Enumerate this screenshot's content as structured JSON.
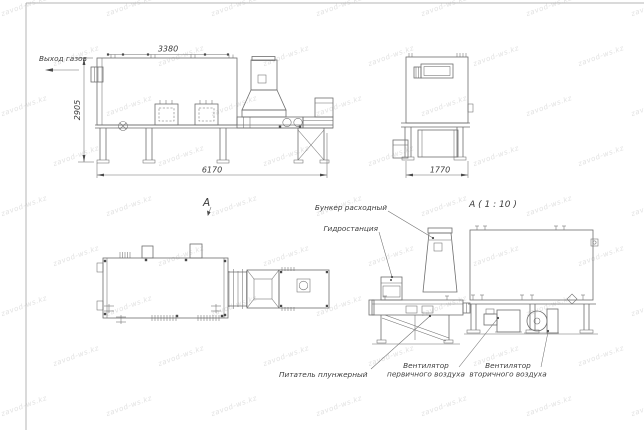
{
  "watermark": {
    "text": "zavod-ws.kz"
  },
  "colors": {
    "background": "#ffffff",
    "line": "#6e6e6e",
    "line_light": "#b4b4b4",
    "text": "#3d3d3d",
    "fill": "#4a4a4a",
    "watermark": "#e2e2e2"
  },
  "front_view": {
    "gas_outlet_label": "Выход газов",
    "dim_top": "3380",
    "dim_height": "2905",
    "dim_length": "6170",
    "view_label": "А"
  },
  "side_view": {
    "dim_width": "1770"
  },
  "detail_view": {
    "title": "А ( 1 : 10 )",
    "callout_hopper": "Бункер расходный",
    "callout_hydraulic": "Гидростанция",
    "callout_feeder": "Питатель плунжерный",
    "callout_primary_fan_1": "Вентилятор",
    "callout_primary_fan_2": "первичного воздуха",
    "callout_secondary_fan_1": "Вентилятор",
    "callout_secondary_fan_2": "вторичного воздуха"
  }
}
